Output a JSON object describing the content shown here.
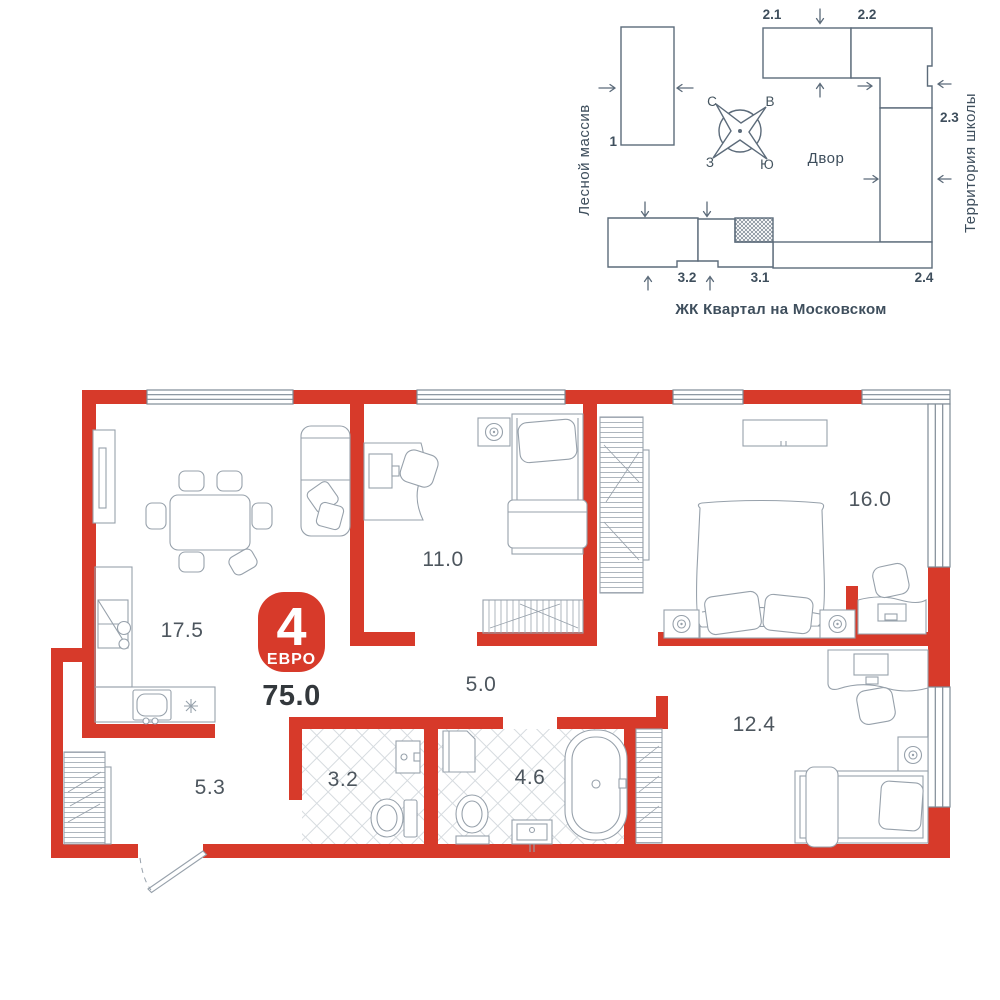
{
  "site_plan": {
    "labels": {
      "left_area": "Лесной массив",
      "right_area": "Территория школы",
      "courtyard": "Двор",
      "caption": "ЖК Квартал на Московском"
    },
    "compass": {
      "n": "С",
      "e": "В",
      "w": "З",
      "s": "Ю"
    },
    "buildings": {
      "b1": "1",
      "b21": "2.1",
      "b22": "2.2",
      "b23": "2.3",
      "b24": "2.4",
      "b31": "3.1",
      "b32": "3.2"
    }
  },
  "floor_plan": {
    "badge": {
      "rooms": "4",
      "format": "ЕВРО"
    },
    "total_area": "75.0",
    "rooms": {
      "kitchen_living": "17.5",
      "bedroom1": "11.0",
      "bedroom2": "16.0",
      "corridor": "5.0",
      "bedroom3": "12.4",
      "hallway": "5.3",
      "bathroom1": "3.2",
      "bathroom2": "4.6"
    }
  },
  "colors": {
    "wall_red": "#d73a2a",
    "furniture_line": "#97a1ab",
    "window_line": "#7f8b96",
    "site_line": "#5c6b7a",
    "text_dark": "#3e4e5c"
  }
}
